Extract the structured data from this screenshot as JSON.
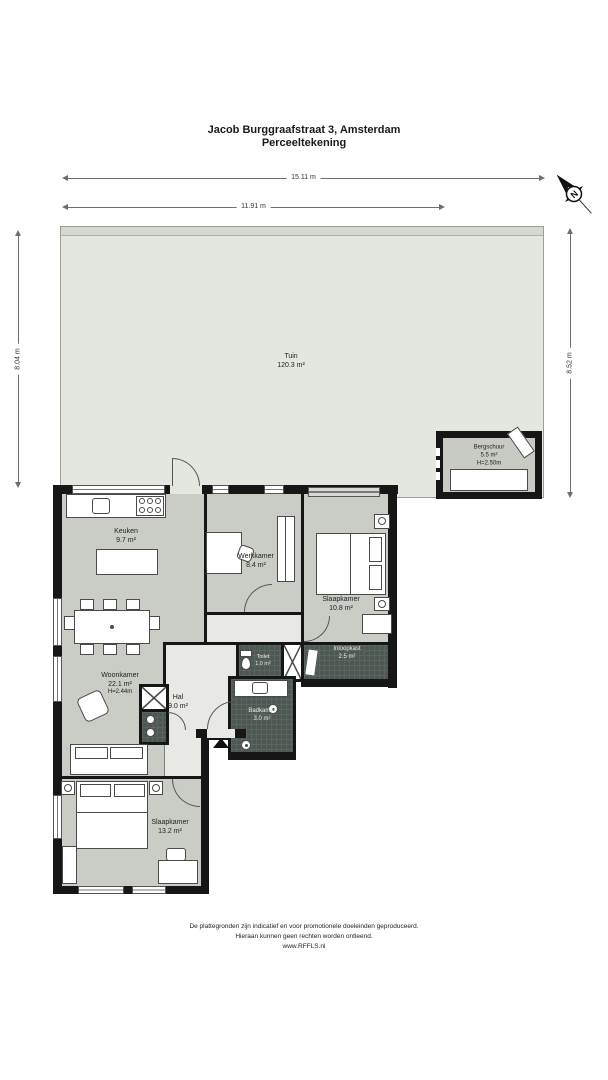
{
  "title": {
    "address": "Jacob Burggraafstraat 3, Amsterdam",
    "subtitle": "Perceeltekening"
  },
  "compass": {
    "label": "N"
  },
  "dimensions": {
    "top": "15.11 m",
    "inner": "11.91 m",
    "left": "8.04 m",
    "right": "8.52 m"
  },
  "garden": {
    "name": "Tuin",
    "area": "120.3 m²"
  },
  "shed": {
    "name": "Bergschuur",
    "area": "5.5 m²",
    "height": "H=2.50m"
  },
  "rooms": {
    "keuken": {
      "name": "Keuken",
      "area": "9.7 m²"
    },
    "werkkamer": {
      "name": "Werkkamer",
      "area": "8.4 m²"
    },
    "slaapkamer_boven": {
      "name": "Slaapkamer",
      "area": "10.8 m²"
    },
    "woonkamer": {
      "name": "Woonkamer",
      "area": "22.1 m²",
      "height": "H=2.44m"
    },
    "hal": {
      "name": "Hal",
      "area": "9.0 m²"
    },
    "inloopkast": {
      "name": "Inloopkast",
      "area": "2.5 m²"
    },
    "toilet": {
      "name": "Toilet",
      "area": "1.0 m²"
    },
    "badkamer": {
      "name": "Badkamer",
      "area": "3.0 m²"
    },
    "slaapkamer_onder": {
      "name": "Slaapkamer",
      "area": "13.2 m²"
    }
  },
  "footer": {
    "line1": "De plattegronden zijn indicatief en voor promotionele doeleinden geproduceerd.",
    "line2": "Hieraan kunnen geen rechten worden ontleend.",
    "line3": "www.RFFLS.nl"
  },
  "colors": {
    "wall": "#161616",
    "room_fill": "#cacdc6",
    "hal_fill": "#e8e9e4",
    "wet_room_fill": "#4d5852",
    "garden_fill": "#e4e7df",
    "shed_fill": "#c7cbc4"
  }
}
